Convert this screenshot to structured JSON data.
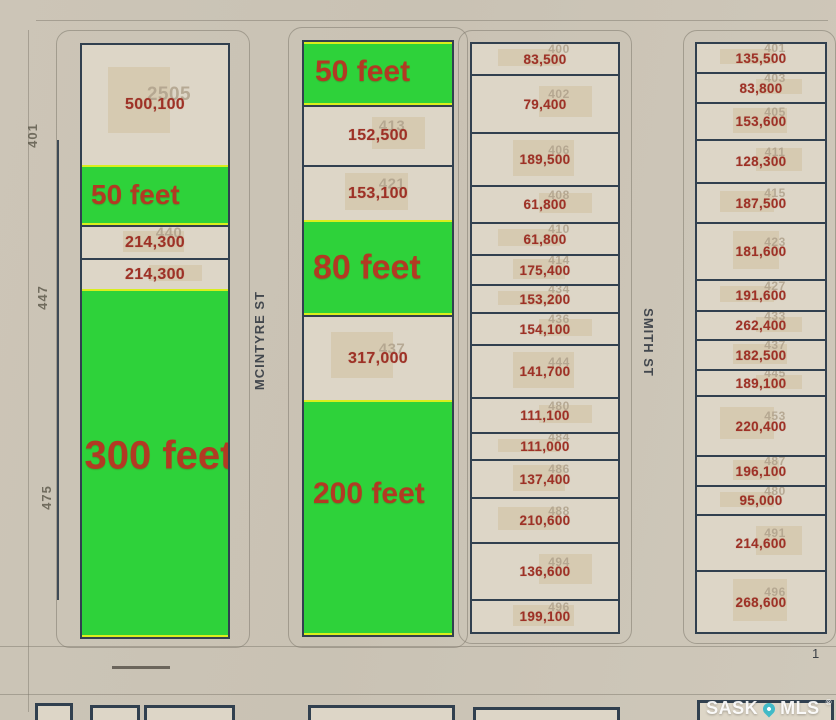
{
  "page": {
    "corner_number": "1",
    "watermark": {
      "brand_left": "SASK",
      "brand_right": "MLS",
      "registered": "®"
    }
  },
  "streets": [
    {
      "name": "MCINTYRE ST"
    },
    {
      "name": "SMITH ST"
    }
  ],
  "colors": {
    "highlight_green": "#2ed23a",
    "highlight_border": "#d9ee1c",
    "value_red": "#9e3126",
    "lot_line": "#31404f",
    "faint_id": "#b0a28c",
    "pin_teal": "#41bac7"
  },
  "blocks": [
    {
      "name": "west-block",
      "side_labels": [
        "401",
        "447",
        "475"
      ],
      "lots": [
        {
          "type": "lot",
          "id": "2505",
          "value": "500,100"
        },
        {
          "type": "highlight",
          "label": "50 feet"
        },
        {
          "type": "lot",
          "id": "440",
          "value": "214,300"
        },
        {
          "type": "lot",
          "id": "",
          "value": "214,300"
        },
        {
          "type": "highlight",
          "label": "300 feet"
        }
      ]
    },
    {
      "name": "mcintyre-west-block",
      "side_labels": [],
      "lots": [
        {
          "type": "highlight",
          "label": "50 feet"
        },
        {
          "type": "lot",
          "id": "413",
          "value": "152,500"
        },
        {
          "type": "lot",
          "id": "421",
          "value": "153,100"
        },
        {
          "type": "highlight",
          "label": "80 feet"
        },
        {
          "type": "lot",
          "id": "437",
          "value": "317,000"
        },
        {
          "type": "highlight",
          "label": "200 feet"
        }
      ]
    },
    {
      "name": "mcintyre-east-block",
      "side_labels": [],
      "lots": [
        {
          "type": "lot",
          "id": "400",
          "value": "83,500"
        },
        {
          "type": "lot",
          "id": "402",
          "value": "79,400"
        },
        {
          "type": "lot",
          "id": "406",
          "value": "189,500"
        },
        {
          "type": "lot",
          "id": "408",
          "value": "61,800"
        },
        {
          "type": "lot",
          "id": "410",
          "value": "61,800"
        },
        {
          "type": "lot",
          "id": "414",
          "value": "175,400"
        },
        {
          "type": "lot",
          "id": "434",
          "value": "153,200"
        },
        {
          "type": "lot",
          "id": "436",
          "value": "154,100"
        },
        {
          "type": "lot",
          "id": "444",
          "value": "141,700"
        },
        {
          "type": "lot",
          "id": "480",
          "value": "111,100"
        },
        {
          "type": "lot",
          "id": "484",
          "value": "111,000"
        },
        {
          "type": "lot",
          "id": "486",
          "value": "137,400"
        },
        {
          "type": "lot",
          "id": "488",
          "value": "210,600"
        },
        {
          "type": "lot",
          "id": "494",
          "value": "136,600"
        },
        {
          "type": "lot",
          "id": "496",
          "value": "199,100"
        }
      ]
    },
    {
      "name": "smith-east-block",
      "side_labels": [],
      "lots": [
        {
          "type": "lot",
          "id": "401",
          "value": "135,500"
        },
        {
          "type": "lot",
          "id": "403",
          "value": "83,800"
        },
        {
          "type": "lot",
          "id": "405",
          "value": "153,600"
        },
        {
          "type": "lot",
          "id": "411",
          "value": "128,300"
        },
        {
          "type": "lot",
          "id": "415",
          "value": "187,500"
        },
        {
          "type": "lot",
          "id": "423",
          "value": "181,600"
        },
        {
          "type": "lot",
          "id": "427",
          "value": "191,600"
        },
        {
          "type": "lot",
          "id": "433",
          "value": "262,400"
        },
        {
          "type": "lot",
          "id": "437",
          "value": "182,500"
        },
        {
          "type": "lot",
          "id": "445",
          "value": "189,100"
        },
        {
          "type": "lot",
          "id": "453",
          "value": "220,400"
        },
        {
          "type": "lot",
          "id": "487",
          "value": "196,100"
        },
        {
          "type": "lot",
          "id": "480",
          "value": "95,000"
        },
        {
          "type": "lot",
          "id": "491",
          "value": "214,600"
        },
        {
          "type": "lot",
          "id": "496",
          "value": "268,600"
        }
      ]
    }
  ]
}
